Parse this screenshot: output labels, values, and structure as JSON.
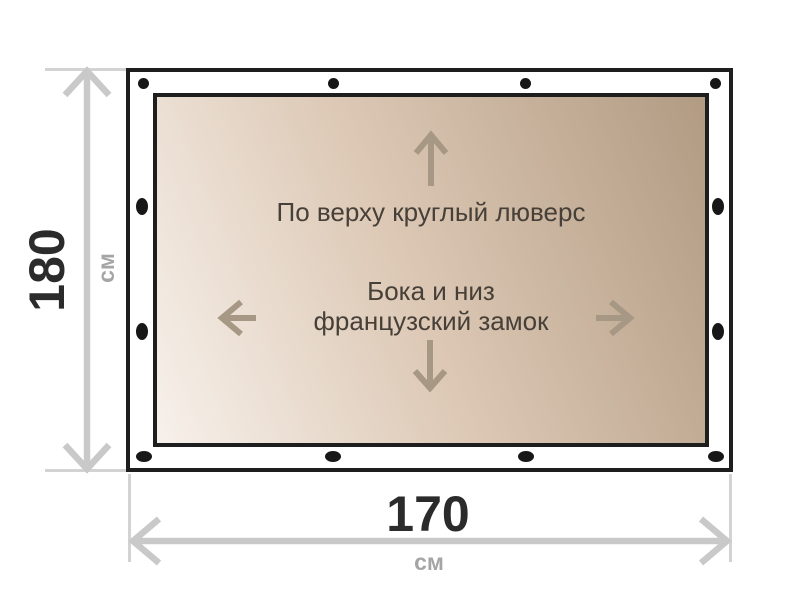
{
  "colors": {
    "page-bg": "#ffffff",
    "frame-border": "#1e1e1e",
    "grommet": "#171717",
    "canvas-light": "#f7f1eb",
    "canvas-mid": "#ddc9b6",
    "canvas-dark": "#b29b83",
    "canvas-text": "#474038",
    "inner-arrow": "#a69884",
    "dimension-line": "#c9c9c9",
    "extension-line": "#d3d3d3",
    "dimension-value": "#2b2b2b",
    "unit-text": "#a5a5a5"
  },
  "diagram": {
    "notes": {
      "top": "По верху круглый люверс",
      "middle_line1": "Бока и низ",
      "middle_line2": "французский замок"
    },
    "height_dimension": {
      "value": "180",
      "unit": "см"
    },
    "width_dimension": {
      "value": "170",
      "unit": "см"
    },
    "fasteners": {
      "top_round_grommets": 4,
      "left_french_locks": 2,
      "right_french_locks": 2,
      "bottom_french_locks": 4
    }
  }
}
